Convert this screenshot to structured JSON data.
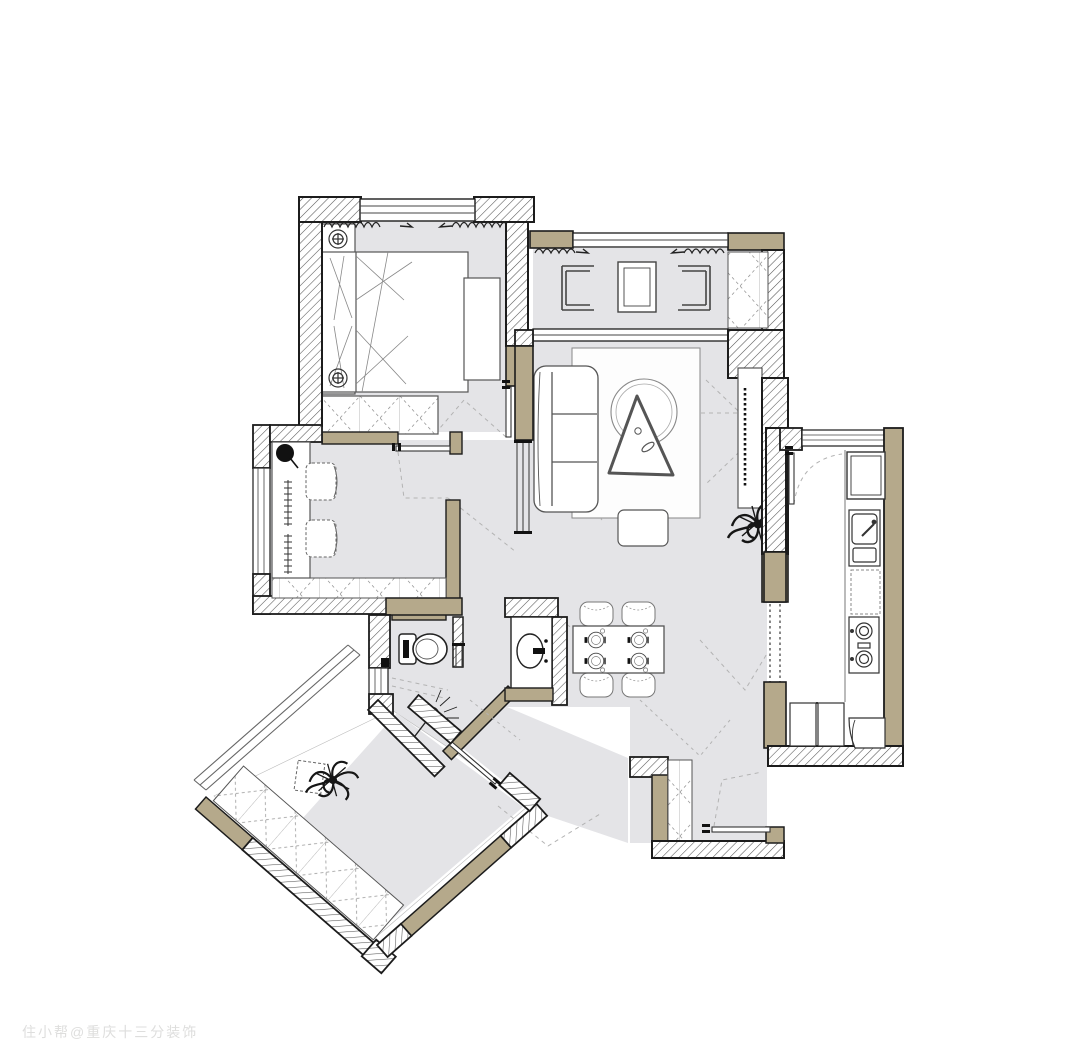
{
  "watermark": {
    "text": "住小帮@重庆十三分装饰"
  },
  "colors": {
    "paper": "#ffffff",
    "floor_gray": "#e4e4e7",
    "wall_tan": "#b5a98b",
    "wall_outline": "#1c1c1c",
    "hatch_line": "#555555",
    "furniture_line": "#555555",
    "guide_dash": "#b3b3b3",
    "watermark_gray": "#dededd"
  },
  "plan": {
    "type": "apartment-floor-plan",
    "rooms": [
      {
        "name": "master-bedroom",
        "position": "top-left",
        "furniture": [
          "double-bed",
          "pillows",
          "nightstand-with-lamp-top",
          "nightstand-with-lamp-bottom",
          "dresser",
          "wardrobe",
          "window",
          "curtains",
          "swing-door"
        ]
      },
      {
        "name": "balcony",
        "position": "top-right",
        "furniture": [
          "lounge-chair-left",
          "lounge-chair-right",
          "side-table",
          "storage-cabinet",
          "curtains",
          "window-rail"
        ]
      },
      {
        "name": "living-room",
        "position": "center-right",
        "furniture": [
          "sofa",
          "area-rug",
          "round-rug",
          "triangle-coffee-table",
          "ottoman",
          "tv-cabinet",
          "tv",
          "plant",
          "pocket-door"
        ]
      },
      {
        "name": "study",
        "position": "center-left",
        "furniture": [
          "desk",
          "desk-lamp",
          "task-chair-top",
          "task-chair-bottom",
          "low-cabinet",
          "window",
          "swing-door"
        ]
      },
      {
        "name": "dining-area",
        "position": "center",
        "furniture": [
          "dining-table",
          "chair-x4",
          "place-setting-x4"
        ]
      },
      {
        "name": "bathroom",
        "position": "center-bottom",
        "furniture": [
          "toilet",
          "washbasin-counter",
          "shower-head",
          "pocket-door",
          "window"
        ]
      },
      {
        "name": "kitchen",
        "position": "right",
        "furniture": [
          "fridge",
          "sink",
          "gas-stove",
          "counter",
          "base-cabinet-x2",
          "corner-shelf",
          "swing-door",
          "sliding-door",
          "window"
        ]
      },
      {
        "name": "entry",
        "position": "bottom-center",
        "furniture": [
          "shoe-cabinet",
          "sliding-entry-door"
        ]
      },
      {
        "name": "second-bedroom",
        "position": "bottom-left-diagonal",
        "furniture": [
          "wardrobe-run",
          "bed-platform",
          "side-table",
          "plant",
          "bay-window",
          "sliding-door"
        ]
      }
    ]
  }
}
